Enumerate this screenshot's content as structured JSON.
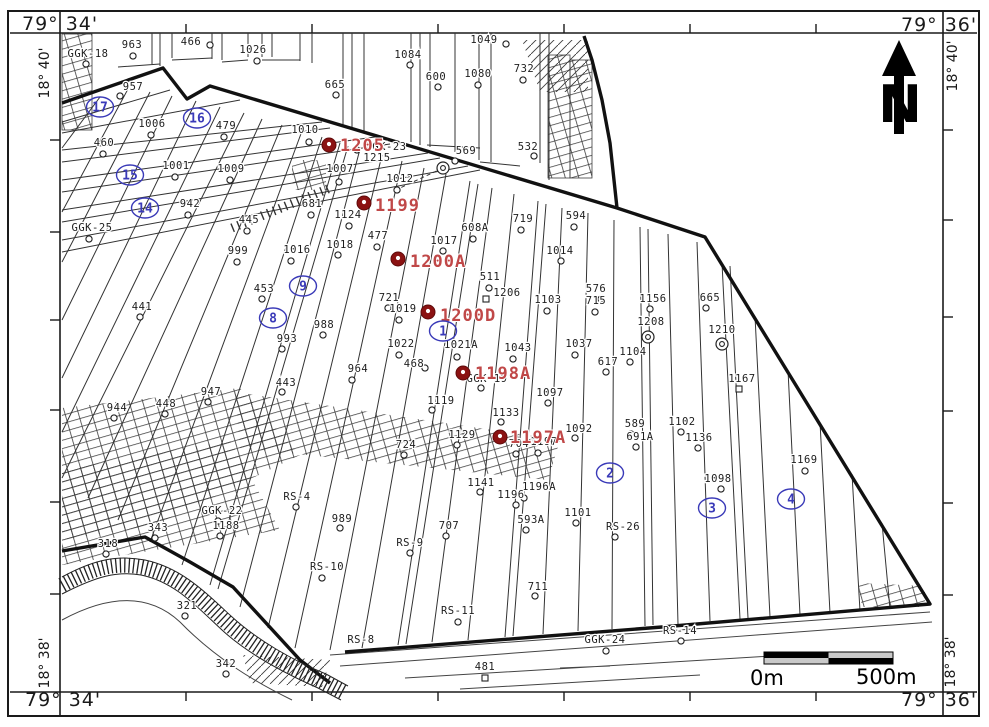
{
  "map": {
    "corner_labels": {
      "top_left": "79° 34'",
      "top_right": "79° 36'",
      "bottom_left": "79° 34'",
      "bottom_right": "79° 36'"
    },
    "side_labels": {
      "left_top": "18° 40'",
      "left_bottom": "18° 38'",
      "right_top": "18° 40'",
      "right_bottom": "18° 38'"
    },
    "north_arrow_label": "N",
    "scale_bar": {
      "left_label": "0m",
      "right_label": "500m"
    },
    "colors": {
      "line": "#1a1a1a",
      "red_label": "#c04848",
      "red_marker": "#8b1212",
      "blue": "#3a3ab8"
    },
    "ticks": {
      "top_x": [
        186,
        312,
        438,
        564,
        690,
        816
      ],
      "bottom_x": [
        186,
        312,
        438,
        564,
        690,
        816
      ],
      "left_y": [
        140,
        232,
        320,
        410,
        502,
        594
      ],
      "right_y": [
        130,
        220,
        317,
        411,
        503,
        595
      ]
    },
    "wells": [
      {
        "label": "GGK-18",
        "x": 88,
        "y": 57,
        "mx": 86,
        "my": 64,
        "t": "c"
      },
      {
        "label": "963",
        "x": 132,
        "y": 48,
        "mx": 133,
        "my": 56,
        "t": "c"
      },
      {
        "label": "466",
        "x": 191,
        "y": 45,
        "mx": 210,
        "my": 45,
        "t": "c"
      },
      {
        "label": "1026",
        "x": 253,
        "y": 53,
        "mx": 257,
        "my": 61,
        "t": "c"
      },
      {
        "label": "957",
        "x": 133,
        "y": 90,
        "mx": 120,
        "my": 96,
        "t": "c"
      },
      {
        "label": "1084",
        "x": 408,
        "y": 58,
        "mx": 410,
        "my": 65,
        "t": "c"
      },
      {
        "label": "1049",
        "x": 484,
        "y": 43,
        "mx": 506,
        "my": 44,
        "t": "c"
      },
      {
        "label": "600",
        "x": 436,
        "y": 80,
        "mx": 438,
        "my": 87,
        "t": "c"
      },
      {
        "label": "1080",
        "x": 478,
        "y": 77,
        "mx": 478,
        "my": 85,
        "t": "c"
      },
      {
        "label": "732",
        "x": 524,
        "y": 72,
        "mx": 523,
        "my": 80,
        "t": "c"
      },
      {
        "label": "665",
        "x": 335,
        "y": 88,
        "mx": 336,
        "my": 95,
        "t": "c"
      },
      {
        "label": "532",
        "x": 528,
        "y": 150,
        "mx": 534,
        "my": 156,
        "t": "c"
      },
      {
        "label": "GGK-23",
        "x": 386,
        "y": 150,
        "mx": 357,
        "my": 150,
        "t": "c"
      },
      {
        "label": "1215",
        "x": 377,
        "y": 161,
        "mx": 443,
        "my": 168,
        "t": "d"
      },
      {
        "label": "569",
        "x": 466,
        "y": 154,
        "mx": 455,
        "my": 161,
        "t": "c"
      },
      {
        "label": "594",
        "x": 576,
        "y": 219,
        "mx": 574,
        "my": 227,
        "t": "c"
      },
      {
        "label": "719",
        "x": 523,
        "y": 222,
        "mx": 521,
        "my": 230,
        "t": "c"
      },
      {
        "label": "608A",
        "x": 475,
        "y": 231,
        "mx": 473,
        "my": 239,
        "t": "c"
      },
      {
        "label": "1010",
        "x": 305,
        "y": 133,
        "mx": 309,
        "my": 142,
        "t": "c"
      },
      {
        "label": "1006",
        "x": 152,
        "y": 127,
        "mx": 151,
        "my": 135,
        "t": "c"
      },
      {
        "label": "479",
        "x": 226,
        "y": 129,
        "mx": 224,
        "my": 137,
        "t": "c"
      },
      {
        "label": "460",
        "x": 104,
        "y": 146,
        "mx": 103,
        "my": 154,
        "t": "c"
      },
      {
        "label": "1001",
        "x": 176,
        "y": 169,
        "mx": 175,
        "my": 177,
        "t": "c"
      },
      {
        "label": "1009",
        "x": 231,
        "y": 172,
        "mx": 230,
        "my": 180,
        "t": "c"
      },
      {
        "label": "942",
        "x": 190,
        "y": 207,
        "mx": 188,
        "my": 215,
        "t": "c"
      },
      {
        "label": "GGK-25",
        "x": 92,
        "y": 231,
        "mx": 89,
        "my": 239,
        "t": "c"
      },
      {
        "label": "445",
        "x": 249,
        "y": 223,
        "mx": 247,
        "my": 231,
        "t": "c"
      },
      {
        "label": "681",
        "x": 312,
        "y": 207,
        "mx": 311,
        "my": 215,
        "t": "c"
      },
      {
        "label": "1007",
        "x": 340,
        "y": 172,
        "mx": 339,
        "my": 182,
        "t": "c"
      },
      {
        "label": "1012",
        "x": 400,
        "y": 182,
        "mx": 397,
        "my": 190,
        "t": "c"
      },
      {
        "label": "1124",
        "x": 348,
        "y": 218,
        "mx": 349,
        "my": 226,
        "t": "c"
      },
      {
        "label": "477",
        "x": 378,
        "y": 239,
        "mx": 377,
        "my": 247,
        "t": "c"
      },
      {
        "label": "1017",
        "x": 444,
        "y": 244,
        "mx": 443,
        "my": 251,
        "t": "c"
      },
      {
        "label": "1018",
        "x": 340,
        "y": 248,
        "mx": 338,
        "my": 255,
        "t": "c"
      },
      {
        "label": "1016",
        "x": 297,
        "y": 253,
        "mx": 291,
        "my": 261,
        "t": "c"
      },
      {
        "label": "999",
        "x": 238,
        "y": 254,
        "mx": 237,
        "my": 262,
        "t": "c"
      },
      {
        "label": "453",
        "x": 264,
        "y": 292,
        "mx": 262,
        "my": 299,
        "t": "c"
      },
      {
        "label": "441",
        "x": 142,
        "y": 310,
        "mx": 140,
        "my": 317,
        "t": "c"
      },
      {
        "label": "988",
        "x": 324,
        "y": 328,
        "mx": 323,
        "my": 335,
        "t": "c"
      },
      {
        "label": "993",
        "x": 287,
        "y": 342,
        "mx": 282,
        "my": 349,
        "t": "c"
      },
      {
        "label": "721",
        "x": 389,
        "y": 301,
        "mx": 388,
        "my": 308,
        "t": "c"
      },
      {
        "label": "1019",
        "x": 403,
        "y": 312,
        "mx": 399,
        "my": 320,
        "t": "c"
      },
      {
        "label": "511",
        "x": 490,
        "y": 280,
        "mx": 489,
        "my": 288,
        "t": "c"
      },
      {
        "label": "1206",
        "x": 507,
        "y": 296,
        "mx": 486,
        "my": 299,
        "t": "s"
      },
      {
        "label": "1103",
        "x": 548,
        "y": 303,
        "mx": 547,
        "my": 311,
        "t": "c"
      },
      {
        "label": "576",
        "x": 596,
        "y": 292,
        "mx": 601,
        "my": 299,
        "t": "c"
      },
      {
        "label": "715",
        "x": 596,
        "y": 304,
        "mx": 595,
        "my": 312,
        "t": "c"
      },
      {
        "label": "1156",
        "x": 653,
        "y": 302,
        "mx": 650,
        "my": 309,
        "t": "c"
      },
      {
        "label": "665",
        "x": 710,
        "y": 301,
        "mx": 706,
        "my": 308,
        "t": "c"
      },
      {
        "label": "1208",
        "x": 651,
        "y": 325,
        "mx": 648,
        "my": 337,
        "t": "d"
      },
      {
        "label": "1210",
        "x": 722,
        "y": 333,
        "mx": 722,
        "my": 344,
        "t": "d"
      },
      {
        "label": "1014",
        "x": 560,
        "y": 254,
        "mx": 561,
        "my": 261,
        "t": "c"
      },
      {
        "label": "1022",
        "x": 401,
        "y": 347,
        "mx": 399,
        "my": 355,
        "t": "c"
      },
      {
        "label": "1021A",
        "x": 461,
        "y": 348,
        "mx": 457,
        "my": 357,
        "t": "c"
      },
      {
        "label": "1043",
        "x": 518,
        "y": 351,
        "mx": 513,
        "my": 359,
        "t": "c"
      },
      {
        "label": "1037",
        "x": 579,
        "y": 347,
        "mx": 575,
        "my": 355,
        "t": "c"
      },
      {
        "label": "1104",
        "x": 633,
        "y": 355,
        "mx": 630,
        "my": 362,
        "t": "c"
      },
      {
        "label": "617",
        "x": 608,
        "y": 365,
        "mx": 606,
        "my": 372,
        "t": "c"
      },
      {
        "label": "GGK-19",
        "x": 487,
        "y": 382,
        "mx": 481,
        "my": 388,
        "t": "c"
      },
      {
        "label": "1097",
        "x": 550,
        "y": 396,
        "mx": 548,
        "my": 403,
        "t": "c"
      },
      {
        "label": "964",
        "x": 358,
        "y": 372,
        "mx": 352,
        "my": 380,
        "t": "c"
      },
      {
        "label": "468",
        "x": 414,
        "y": 367,
        "mx": 425,
        "my": 368,
        "t": "c"
      },
      {
        "label": "1119",
        "x": 441,
        "y": 404,
        "mx": 432,
        "my": 410,
        "t": "c"
      },
      {
        "label": "443",
        "x": 286,
        "y": 386,
        "mx": 282,
        "my": 392,
        "t": "c"
      },
      {
        "label": "947",
        "x": 211,
        "y": 395,
        "mx": 208,
        "my": 402,
        "t": "c"
      },
      {
        "label": "448",
        "x": 166,
        "y": 407,
        "mx": 165,
        "my": 414,
        "t": "c"
      },
      {
        "label": "944",
        "x": 117,
        "y": 411,
        "mx": 114,
        "my": 418,
        "t": "c"
      },
      {
        "label": "1133",
        "x": 506,
        "y": 416,
        "mx": 501,
        "my": 422,
        "t": "c"
      },
      {
        "label": "1129",
        "x": 462,
        "y": 438,
        "mx": 457,
        "my": 445,
        "t": "c"
      },
      {
        "label": "704",
        "x": 519,
        "y": 447,
        "mx": 516,
        "my": 454,
        "t": "c"
      },
      {
        "label": "1197",
        "x": 544,
        "y": 445,
        "mx": 538,
        "my": 453,
        "t": "c"
      },
      {
        "label": "1092",
        "x": 579,
        "y": 432,
        "mx": 575,
        "my": 438,
        "t": "c"
      },
      {
        "label": "589",
        "x": 635,
        "y": 427,
        "mx": 631,
        "my": 434,
        "t": "c"
      },
      {
        "label": "691A",
        "x": 640,
        "y": 440,
        "mx": 636,
        "my": 447,
        "t": "c"
      },
      {
        "label": "1102",
        "x": 682,
        "y": 425,
        "mx": 681,
        "my": 432,
        "t": "c"
      },
      {
        "label": "1136",
        "x": 699,
        "y": 441,
        "mx": 698,
        "my": 448,
        "t": "c"
      },
      {
        "label": "1098",
        "x": 718,
        "y": 482,
        "mx": 721,
        "my": 489,
        "t": "c"
      },
      {
        "label": "1169",
        "x": 804,
        "y": 463,
        "mx": 805,
        "my": 471,
        "t": "c"
      },
      {
        "label": "1167",
        "x": 742,
        "y": 382,
        "mx": 739,
        "my": 389,
        "t": "s"
      },
      {
        "label": "724",
        "x": 406,
        "y": 448,
        "mx": 404,
        "my": 455,
        "t": "c"
      },
      {
        "label": "1141",
        "x": 481,
        "y": 486,
        "mx": 480,
        "my": 492,
        "t": "c"
      },
      {
        "label": "1196A",
        "x": 539,
        "y": 490,
        "mx": 524,
        "my": 498,
        "t": "c"
      },
      {
        "label": "1196",
        "x": 511,
        "y": 498,
        "mx": 516,
        "my": 505,
        "t": "c"
      },
      {
        "label": "593A",
        "x": 531,
        "y": 523,
        "mx": 526,
        "my": 530,
        "t": "c"
      },
      {
        "label": "1101",
        "x": 578,
        "y": 516,
        "mx": 576,
        "my": 523,
        "t": "c"
      },
      {
        "label": "RS-26",
        "x": 623,
        "y": 530,
        "mx": 615,
        "my": 537,
        "t": "c"
      },
      {
        "label": "707",
        "x": 449,
        "y": 529,
        "mx": 446,
        "my": 536,
        "t": "c"
      },
      {
        "label": "RS-9",
        "x": 410,
        "y": 546,
        "mx": 410,
        "my": 553,
        "t": "c"
      },
      {
        "label": "989",
        "x": 342,
        "y": 522,
        "mx": 340,
        "my": 528,
        "t": "c"
      },
      {
        "label": "RS-10",
        "x": 327,
        "y": 570,
        "mx": 322,
        "my": 578,
        "t": "c"
      },
      {
        "label": "RS-4",
        "x": 297,
        "y": 500,
        "mx": 296,
        "my": 507,
        "t": "c"
      },
      {
        "label": "GGK-22",
        "x": 222,
        "y": 514,
        "mx": 218,
        "my": 521,
        "t": "c"
      },
      {
        "label": "1188",
        "x": 226,
        "y": 529,
        "mx": 220,
        "my": 536,
        "t": "c"
      },
      {
        "label": "343",
        "x": 158,
        "y": 531,
        "mx": 155,
        "my": 538,
        "t": "c"
      },
      {
        "label": "318",
        "x": 108,
        "y": 547,
        "mx": 106,
        "my": 554,
        "t": "c"
      },
      {
        "label": "321",
        "x": 187,
        "y": 609,
        "mx": 185,
        "my": 616,
        "t": "c"
      },
      {
        "label": "342",
        "x": 226,
        "y": 667,
        "mx": 226,
        "my": 674,
        "t": "c"
      },
      {
        "label": "RS-11",
        "x": 458,
        "y": 614,
        "mx": 458,
        "my": 622,
        "t": "c"
      },
      {
        "label": "711",
        "x": 538,
        "y": 590,
        "mx": 535,
        "my": 596,
        "t": "c"
      },
      {
        "label": "RS-8",
        "x": 361,
        "y": 643,
        "mx": 0,
        "my": 0,
        "t": "n"
      },
      {
        "label": "GGK-24",
        "x": 605,
        "y": 643,
        "mx": 606,
        "my": 651,
        "t": "c"
      },
      {
        "label": "RS-14",
        "x": 680,
        "y": 634,
        "mx": 681,
        "my": 641,
        "t": "c"
      },
      {
        "label": "481",
        "x": 485,
        "y": 670,
        "mx": 485,
        "my": 678,
        "t": "s"
      }
    ],
    "red_wells": [
      {
        "label": "1205",
        "x": 340,
        "y": 151,
        "mx": 329,
        "my": 145
      },
      {
        "label": "1199",
        "x": 375,
        "y": 211,
        "mx": 364,
        "my": 203
      },
      {
        "label": "1200A",
        "x": 410,
        "y": 267,
        "mx": 398,
        "my": 259
      },
      {
        "label": "1200D",
        "x": 440,
        "y": 321,
        "mx": 428,
        "my": 312
      },
      {
        "label": "1198A",
        "x": 475,
        "y": 379,
        "mx": 463,
        "my": 373
      },
      {
        "label": "1197A",
        "x": 510,
        "y": 443,
        "mx": 500,
        "my": 437
      }
    ],
    "blocks": [
      {
        "label": "17",
        "x": 100,
        "y": 107
      },
      {
        "label": "16",
        "x": 197,
        "y": 118
      },
      {
        "label": "15",
        "x": 130,
        "y": 175
      },
      {
        "label": "14",
        "x": 145,
        "y": 208
      },
      {
        "label": "9",
        "x": 303,
        "y": 286
      },
      {
        "label": "8",
        "x": 273,
        "y": 318
      },
      {
        "label": "1",
        "x": 443,
        "y": 331
      },
      {
        "label": "2",
        "x": 610,
        "y": 473
      },
      {
        "label": "3",
        "x": 712,
        "y": 508
      },
      {
        "label": "4",
        "x": 791,
        "y": 499
      }
    ]
  }
}
